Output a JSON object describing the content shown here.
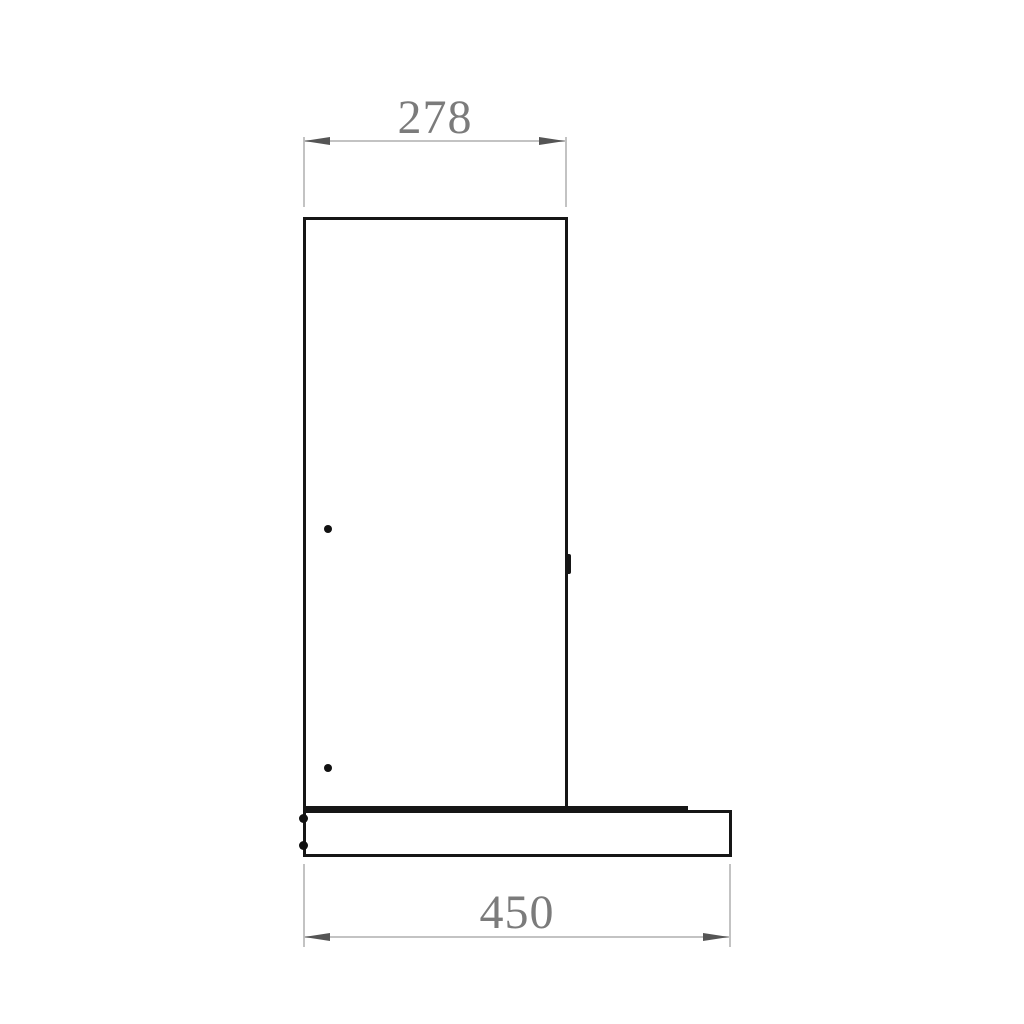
{
  "drawing": {
    "kind": "technical-dimension-drawing",
    "subject": "chimney-hood-side-profile",
    "background_color": "#ffffff",
    "colors": {
      "outline": "#161616",
      "dimension_line": "#c3c3c3",
      "dimension_arrow": "#555555",
      "label_text": "#7b7b7b"
    },
    "icons": {
      "dimension_arrow": "filled-triangle"
    },
    "dimensions": {
      "top": {
        "label": "278"
      },
      "bottom": {
        "label": "450"
      }
    }
  }
}
